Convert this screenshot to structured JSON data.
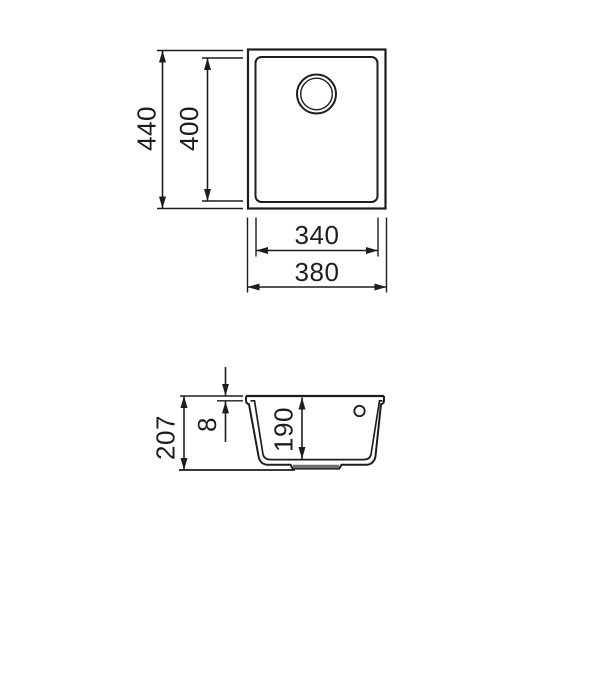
{
  "drawing": {
    "kind": "technical-dimension-drawing",
    "subject": "rectangular undermount sink, top view and section view",
    "unit": "mm",
    "colors": {
      "line": "#1d1d1d",
      "background": "#ffffff",
      "drain_recess": "#6f6f6f"
    },
    "views": {
      "top": {
        "name": "top-view",
        "dims": {
          "overall_height": "440",
          "bowl_height": "400",
          "bowl_width": "340",
          "overall_width": "380"
        }
      },
      "section": {
        "name": "section-view",
        "dims": {
          "total_depth": "207",
          "rim_thickness": "8",
          "bowl_depth": "190"
        }
      }
    }
  }
}
